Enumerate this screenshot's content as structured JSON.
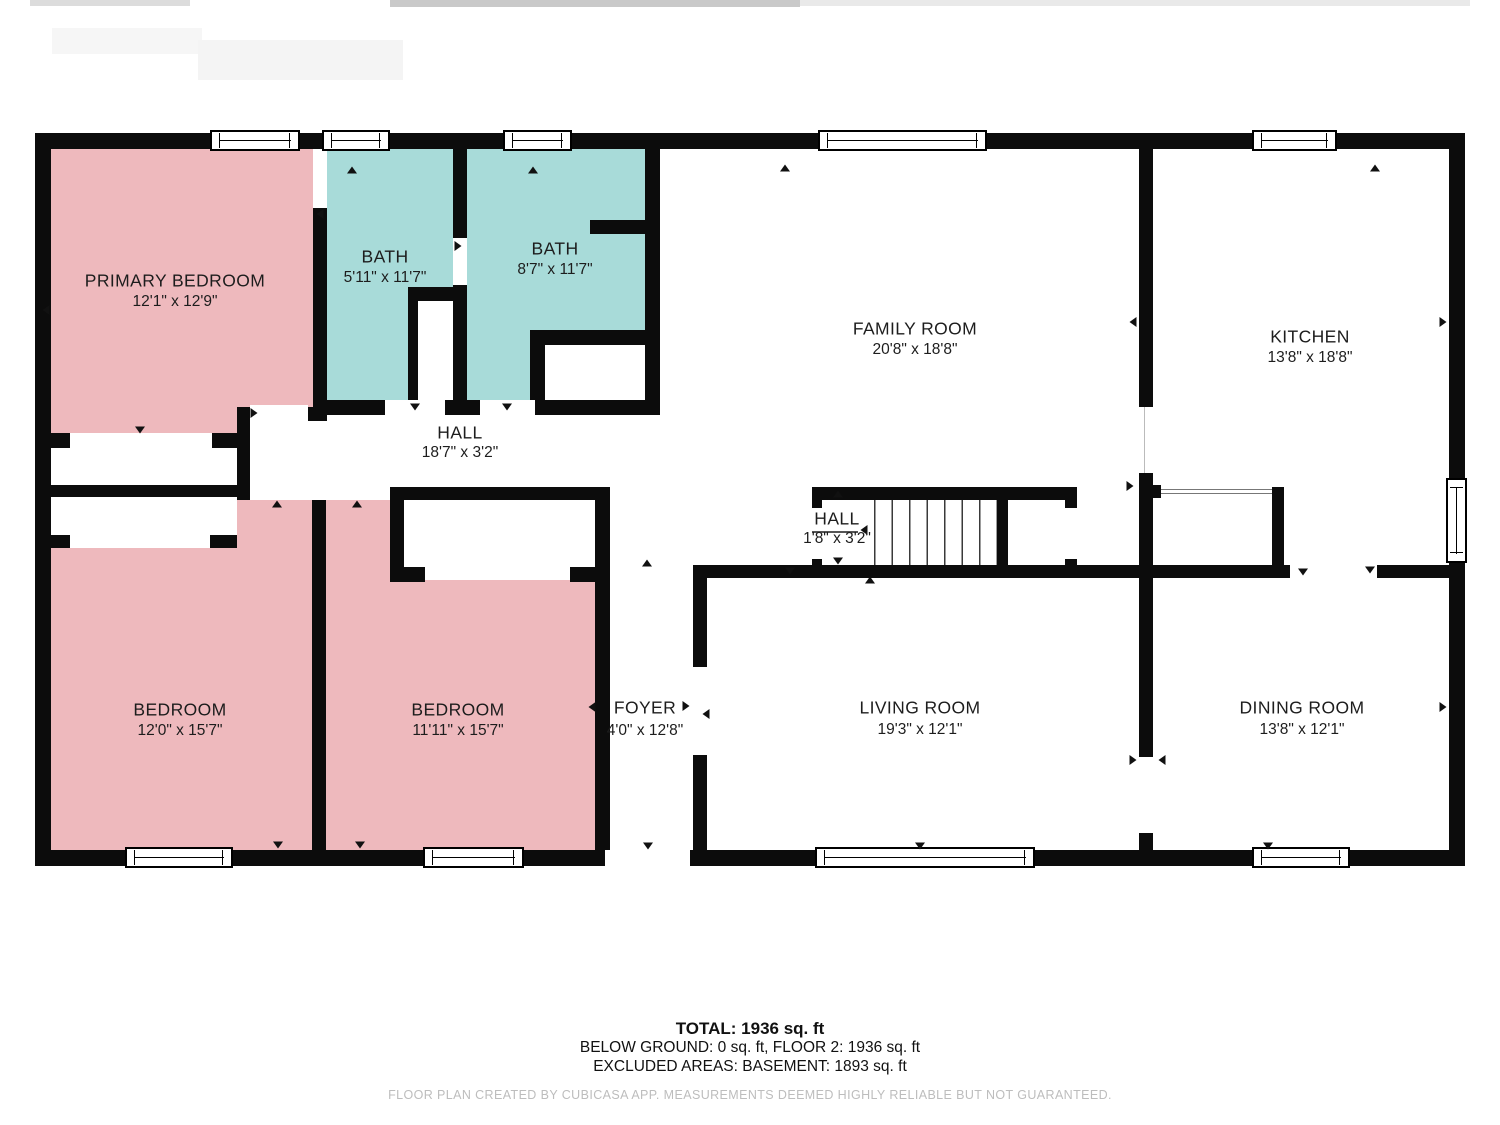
{
  "rooms": [
    {
      "name": "PRIMARY BEDROOM",
      "dims": "12'1\" x 12'9\""
    },
    {
      "name": "BATH",
      "dims": "5'11\" x 11'7\""
    },
    {
      "name": "BATH",
      "dims": "8'7\" x 11'7\""
    },
    {
      "name": "FAMILY ROOM",
      "dims": "20'8\" x 18'8\""
    },
    {
      "name": "KITCHEN",
      "dims": "13'8\" x 18'8\""
    },
    {
      "name": "HALL",
      "dims": "18'7\" x 3'2\""
    },
    {
      "name": "HALL",
      "dims": "1'8\" x 3'2\""
    },
    {
      "name": "BEDROOM",
      "dims": "12'0\" x 15'7\""
    },
    {
      "name": "BEDROOM",
      "dims": "11'11\" x 15'7\""
    },
    {
      "name": "FOYER",
      "dims": "4'0\" x 12'8\""
    },
    {
      "name": "LIVING ROOM",
      "dims": "19'3\" x 12'1\""
    },
    {
      "name": "DINING ROOM",
      "dims": "13'8\" x 12'1\""
    }
  ],
  "summary": {
    "total": "TOTAL: 1936 sq. ft",
    "below_ground": "BELOW GROUND: 0 sq. ft, FLOOR 2: 1936 sq. ft",
    "excluded": "EXCLUDED AREAS: BASEMENT: 1893 sq. ft"
  },
  "footer": "FLOOR PLAN CREATED BY CUBICASA APP. MEASUREMENTS DEEMED HIGHLY RELIABLE BUT NOT GUARANTEED.",
  "colors": {
    "bedroom_fill": "#eeb9bd",
    "bath_fill": "#a8dbd9",
    "wall": "#0c0c0c"
  }
}
